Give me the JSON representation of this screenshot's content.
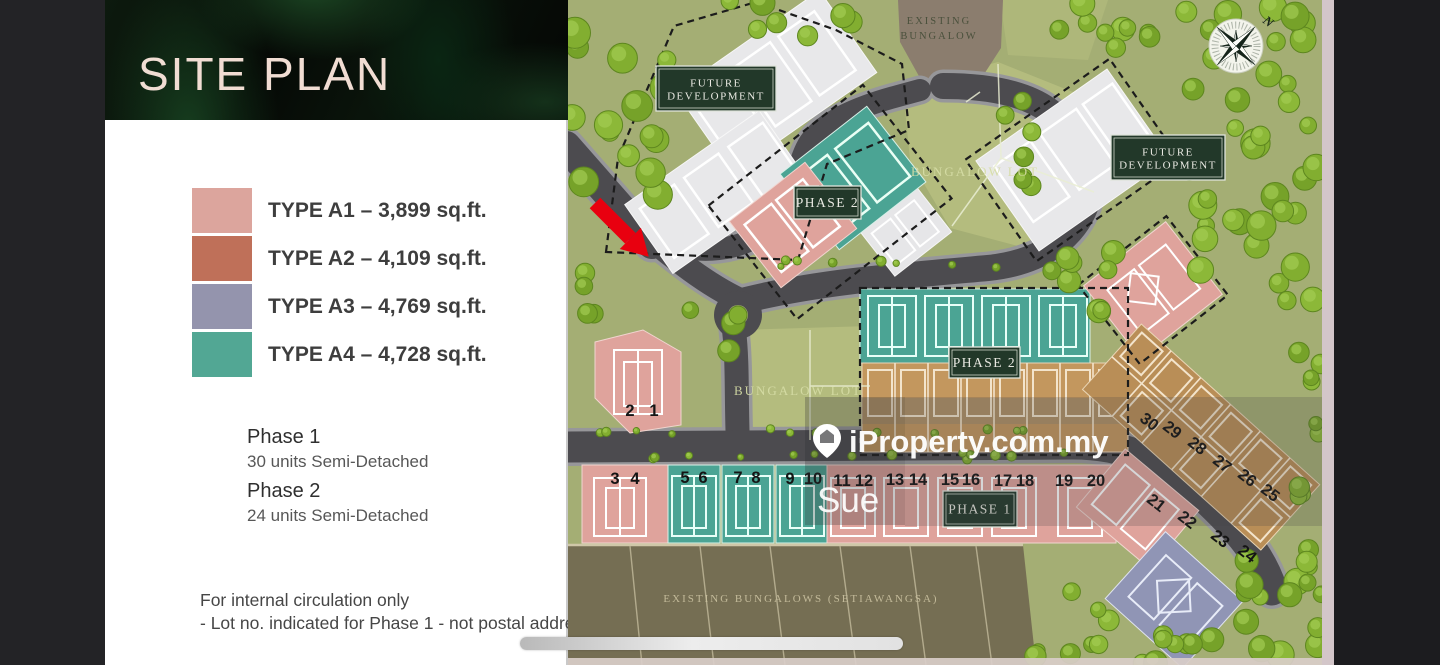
{
  "panel": {
    "title": "SITE PLAN",
    "legend": [
      {
        "label": "TYPE A1 – 3,899 sq.ft.",
        "color": "#dca59d"
      },
      {
        "label": "TYPE A2 – 4,109 sq.ft.",
        "color": "#bf7059"
      },
      {
        "label": "TYPE A3 – 4,769 sq.ft.",
        "color": "#9494ad"
      },
      {
        "label": "TYPE A4 – 4,728 sq.ft.",
        "color": "#52a794"
      }
    ],
    "phases": [
      {
        "name": "Phase 1",
        "detail": "30 units Semi-Detached"
      },
      {
        "name": "Phase 2",
        "detail": "24 units Semi-Detached"
      }
    ],
    "notes": [
      "For internal circulation only",
      "- Lot no. indicated for Phase 1 - not postal address"
    ]
  },
  "plan": {
    "signs": [
      {
        "lines": [
          "FUTURE",
          "DEVELOPMENT"
        ],
        "x": 88,
        "y": 66,
        "w": 120,
        "h": 45,
        "fs": 11
      },
      {
        "lines": [
          "FUTURE",
          "DEVELOPMENT"
        ],
        "x": 543,
        "y": 135,
        "w": 114,
        "h": 45,
        "fs": 11
      },
      {
        "lines": [
          "PHASE 2"
        ],
        "x": 226,
        "y": 186,
        "w": 67,
        "h": 33,
        "fs": 13.5
      },
      {
        "lines": [
          "PHASE 2"
        ],
        "x": 381,
        "y": 347,
        "w": 71,
        "h": 31,
        "fs": 13.5
      },
      {
        "lines": [
          "PHASE 1"
        ],
        "x": 375,
        "y": 491,
        "w": 74,
        "h": 36,
        "fs": 13.5
      }
    ],
    "area_labels": [
      {
        "text": "EXISTING",
        "x": 371,
        "y": 24,
        "style": "dark",
        "fs": 10.5
      },
      {
        "text": "BUNGALOW",
        "x": 371,
        "y": 39,
        "style": "dark",
        "fs": 10.5
      },
      {
        "text": "BUNGALOW LOT",
        "x": 407,
        "y": 176,
        "style": "light",
        "fs": 13
      },
      {
        "text": "BUNGALOW LOT",
        "x": 230,
        "y": 395,
        "style": "light",
        "fs": 13
      },
      {
        "text": "EXISTING BUNGALOWS (SETIAWANGSA)",
        "x": 233,
        "y": 602,
        "style": "tan",
        "fs": 11
      }
    ],
    "compass_label": "N",
    "lot_numbers": [
      {
        "n": "2",
        "x": 62,
        "y": 416
      },
      {
        "n": "1",
        "x": 86,
        "y": 416
      },
      {
        "n": "3",
        "x": 47,
        "y": 484
      },
      {
        "n": "4",
        "x": 67,
        "y": 484
      },
      {
        "n": "5",
        "x": 117,
        "y": 483
      },
      {
        "n": "6",
        "x": 135,
        "y": 483
      },
      {
        "n": "7",
        "x": 170,
        "y": 483
      },
      {
        "n": "8",
        "x": 188,
        "y": 483
      },
      {
        "n": "9",
        "x": 222,
        "y": 484
      },
      {
        "n": "10",
        "x": 245,
        "y": 484
      },
      {
        "n": "11",
        "x": 274,
        "y": 486
      },
      {
        "n": "12",
        "x": 296,
        "y": 486
      },
      {
        "n": "13",
        "x": 327,
        "y": 485
      },
      {
        "n": "14",
        "x": 350,
        "y": 485
      },
      {
        "n": "15",
        "x": 382,
        "y": 485
      },
      {
        "n": "16",
        "x": 403,
        "y": 485
      },
      {
        "n": "17",
        "x": 435,
        "y": 486
      },
      {
        "n": "18",
        "x": 457,
        "y": 486
      },
      {
        "n": "19",
        "x": 496,
        "y": 486
      },
      {
        "n": "20",
        "x": 528,
        "y": 486
      },
      {
        "n": "21",
        "x": 585,
        "y": 507,
        "rot": 38
      },
      {
        "n": "22",
        "x": 616,
        "y": 524,
        "rot": 38
      },
      {
        "n": "23",
        "x": 649,
        "y": 543,
        "rot": 38
      },
      {
        "n": "24",
        "x": 676,
        "y": 558,
        "rot": 38
      },
      {
        "n": "25",
        "x": 699,
        "y": 497,
        "rot": 38
      },
      {
        "n": "26",
        "x": 676,
        "y": 482,
        "rot": 38
      },
      {
        "n": "27",
        "x": 651,
        "y": 468,
        "rot": 38
      },
      {
        "n": "28",
        "x": 626,
        "y": 450,
        "rot": 38
      },
      {
        "n": "29",
        "x": 601,
        "y": 434,
        "rot": 38
      },
      {
        "n": "30",
        "x": 578,
        "y": 426,
        "rot": 38
      }
    ],
    "watermark": {
      "brand": "iProperty.com.my",
      "agent": "Sue"
    }
  }
}
